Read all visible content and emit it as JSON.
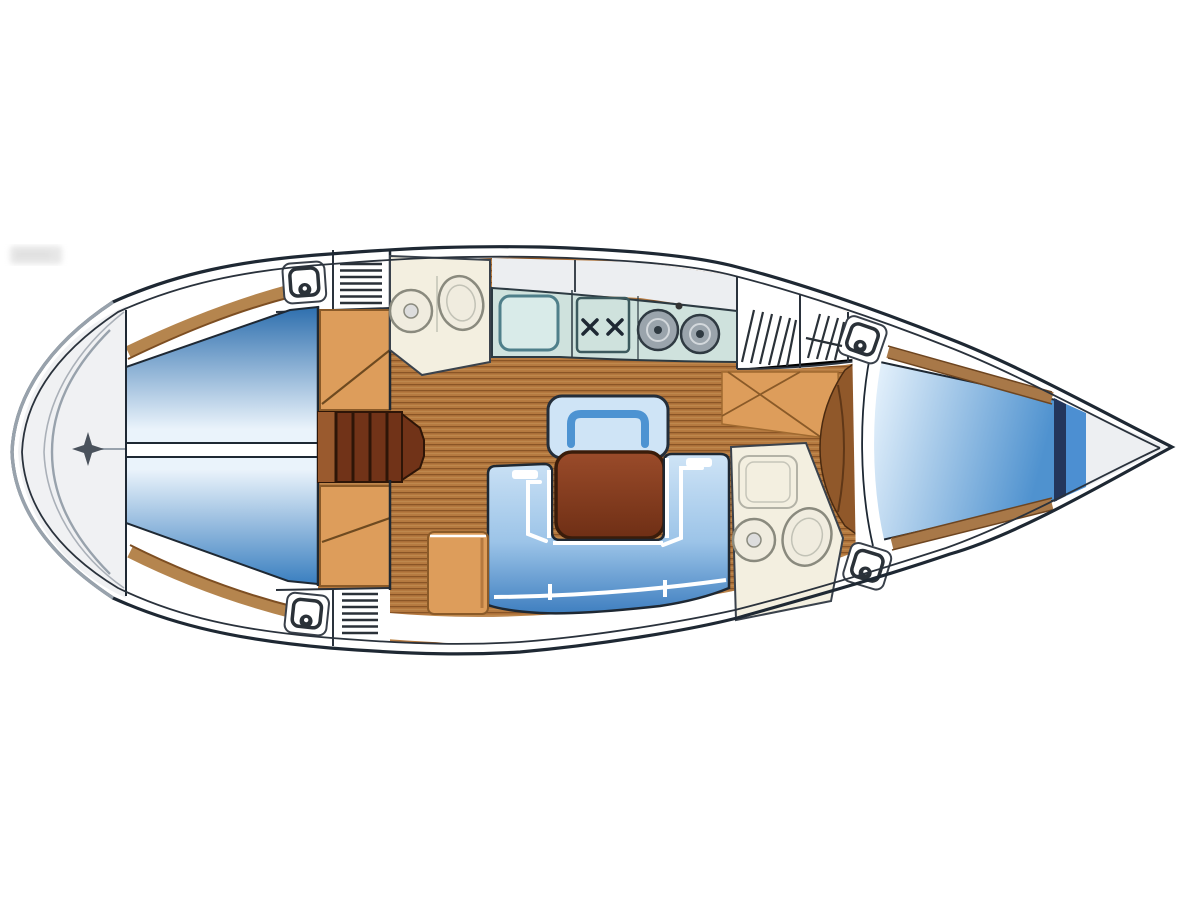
{
  "plan": {
    "type": "yacht-interior-floor-plan",
    "orientation": "bow-right",
    "areas": [
      {
        "id": "transom-deck"
      },
      {
        "id": "aft-cabin-port-berth"
      },
      {
        "id": "aft-cabin-starboard-berth"
      },
      {
        "id": "companionway-steps"
      },
      {
        "id": "aft-head-port"
      },
      {
        "id": "galley"
      },
      {
        "id": "saloon"
      },
      {
        "id": "forward-head-starboard"
      },
      {
        "id": "forward-passage"
      },
      {
        "id": "forecabin-v-berth"
      },
      {
        "id": "anchor-locker"
      }
    ],
    "fixtures": [
      {
        "id": "steering-star"
      },
      {
        "id": "deck-hatch",
        "count": 4
      },
      {
        "id": "vent-grille",
        "count": 2
      },
      {
        "id": "louver-locker",
        "count": 2
      },
      {
        "id": "toilet",
        "count": 2
      },
      {
        "id": "washbasin",
        "count": 2
      },
      {
        "id": "galley-sink"
      },
      {
        "id": "stove-gimbal"
      },
      {
        "id": "burner",
        "count": 2
      },
      {
        "id": "saloon-table"
      },
      {
        "id": "u-settee"
      },
      {
        "id": "bench-seat"
      },
      {
        "id": "side-cabinet"
      }
    ]
  },
  "colors": {
    "outline": "#1e2833",
    "innerLine": "#2a323c",
    "grayLine": "#98a2ac",
    "deckGray": "#eceef1",
    "transomGray": "#f0f1f3",
    "white": "#ffffff",
    "woodFloor": "#b5793f",
    "woodLine": "#8a5526",
    "woodHighlight": "#c99a5f",
    "woodShelf": "#a87848",
    "shelfEdge": "#6e4520",
    "brownStrip": "#b5854e",
    "brownStripEdge": "#7d4e22",
    "stepsDark": "#713318",
    "stepsLight": "#9a5a2e",
    "stepsLine": "#2e1507",
    "doorwayWood": "#90582a",
    "doorwayLine": "#4a2a10",
    "tan": "#dd9d5b",
    "tanEdge": "#8a5a28",
    "tanLine": "#6e4a20",
    "tableLight": "#9a4b2a",
    "tableDark": "#6f2f15",
    "tableOutline": "#3a1c0a",
    "cream": "#f3efe0",
    "creamFixture": "#f0ecdf",
    "fixtureLine": "#8a8a7e",
    "fixtureLineLight": "#c2c2b6",
    "counterTeal": "#cfe2dd",
    "counterOutline": "#2c3a42",
    "sinkFill": "#d9ebe9",
    "sinkOutline": "#4f7f8a",
    "stoveOutline": "#3c5a5e",
    "burnerFill": "#9aa4ac",
    "burnerRing": "#d3d8dc",
    "burnerOutline": "#2f3a42",
    "blueDeep": "#2e6fae",
    "blueBottom": "#3a7fc0",
    "bluePale": "#eaf3fb",
    "settePale": "#cfe4f6",
    "setteMid": "#9cc4e8",
    "setteDeep": "#3f7fc0",
    "backrest": "#4d93d2",
    "vBerthPale": "#e9f4fd",
    "vBerthDeep": "#4f92cf",
    "navyBulkhead": "#23365c",
    "wedgeBlue": "#4c8fd2",
    "forepeak": "#edeff2",
    "star": "#4a525c",
    "hatchLine": "#2a3138",
    "watermark": "#cfcfcf"
  }
}
